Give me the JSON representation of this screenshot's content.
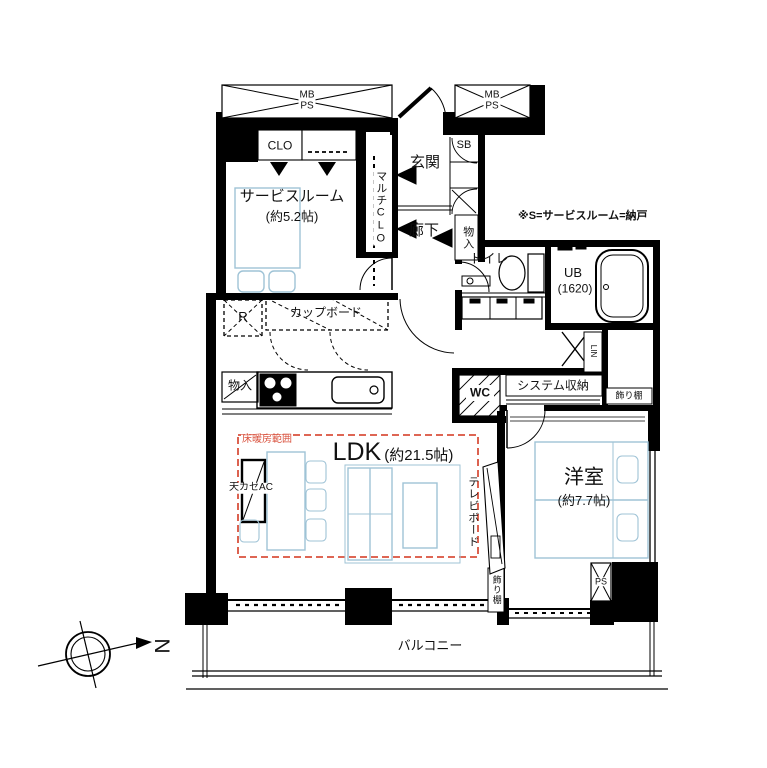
{
  "rooms": {
    "service_room": {
      "name": "サービスルーム",
      "size": "(約5.2帖)"
    },
    "entrance": {
      "name": "玄関"
    },
    "hallway": {
      "name": "廊下"
    },
    "toilet": {
      "name": "トイレ"
    },
    "bathroom": {
      "name": "UB",
      "size": "(1620)"
    },
    "ldk": {
      "name": "LDK",
      "size": "(約21.5帖)"
    },
    "western_room": {
      "name": "洋室",
      "size": "(約7.7帖)"
    },
    "balcony": {
      "name": "バルコニー"
    }
  },
  "storage": {
    "closet": "CLO",
    "multi_closet": "マルチCLO",
    "shoe_box": "SB",
    "hall_storage": "物入",
    "kitchen_storage": "物入",
    "cupboard": "カップボード",
    "refrigerator_space": "R",
    "system_storage": "システム収納",
    "linen": "LIN",
    "display_shelf_top": "飾り棚",
    "display_shelf_side": "飾り棚",
    "washer": "WC"
  },
  "shafts": {
    "meter_pipe_left": {
      "line1": "MB",
      "line2": "PS"
    },
    "meter_pipe_right": {
      "line1": "MB",
      "line2": "PS"
    },
    "pipe_space": "PS"
  },
  "annotations": {
    "note": "※S=サービスルーム=納戸",
    "floor_heating": "床暖房範囲",
    "ceiling_ac": "天カセAC",
    "tv_board": "テレビボード",
    "compass_north": "N"
  },
  "colors": {
    "wall": "#000000",
    "furniture_outline": "#9fc3d6",
    "floor_heating_line": "#d9513d",
    "background": "#ffffff"
  }
}
